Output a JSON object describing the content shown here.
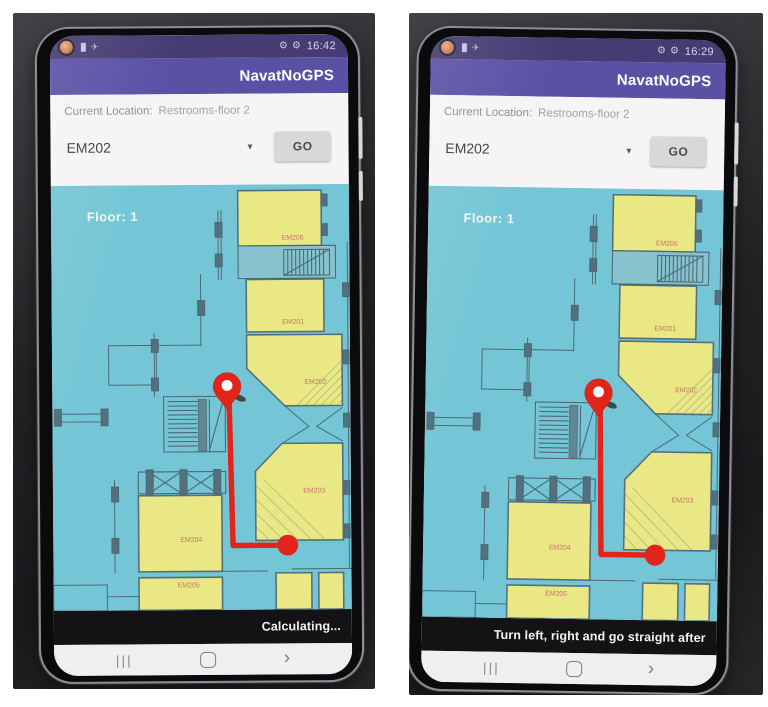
{
  "icons": {
    "airplane": "✈",
    "gear": "⚙",
    "caret": "▾",
    "nav_recents": "|||",
    "nav_back": "›"
  },
  "colors": {
    "status_bar": "#463c73",
    "app_bar": "#5a51a5",
    "map_background": "#74c6d6",
    "room_fill": "#e9e884",
    "route_red": "#e2251b",
    "instruction_bar": "#131315"
  },
  "map": {
    "floor_label": "Floor: 1",
    "rooms": [
      {
        "label": "EM206"
      },
      {
        "label": "EM201"
      },
      {
        "label": "EM202"
      },
      {
        "label": "EM203"
      },
      {
        "label": "EM204"
      },
      {
        "label": "EM205"
      }
    ]
  },
  "phones": [
    {
      "time": "16:42",
      "app_title": "NavatNoGPS",
      "location_label": "Current Location:",
      "location_value": "Restrooms-floor 2",
      "destination_selected": "EM202",
      "go_label": "GO",
      "instruction": "Calculating..."
    },
    {
      "time": "16:29",
      "app_title": "NavatNoGPS",
      "location_label": "Current Location:",
      "location_value": "Restrooms-floor 2",
      "destination_selected": "EM202",
      "go_label": "GO",
      "instruction": "Turn left, right and go straight after"
    }
  ]
}
